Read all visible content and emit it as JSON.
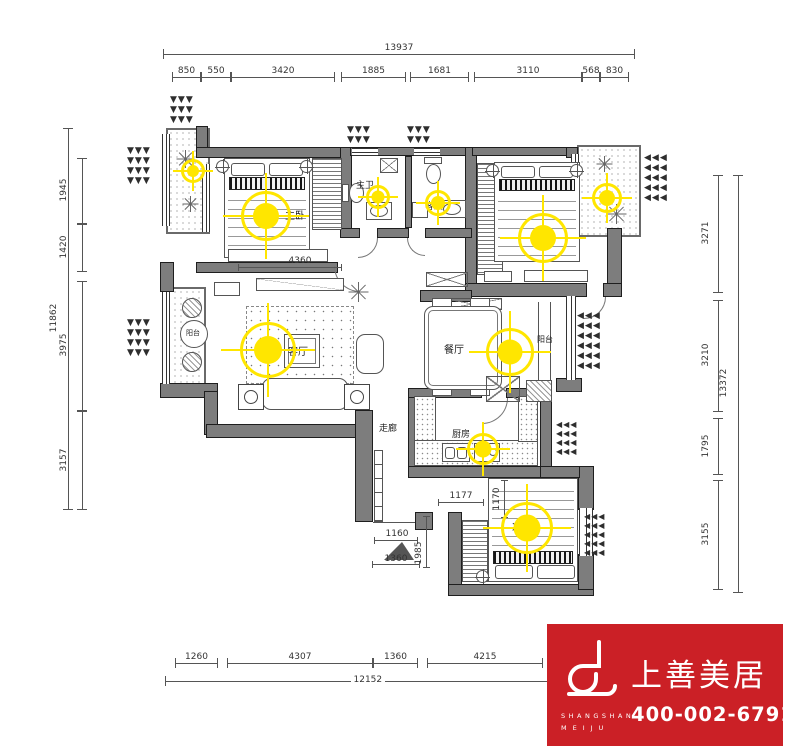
{
  "dims": {
    "top": {
      "total": "13937",
      "segments": [
        "850",
        "550",
        "3420",
        "1885",
        "1681",
        "3110",
        "568",
        "830"
      ]
    },
    "bottom": {
      "total": "12152",
      "segments": [
        "1260",
        "4307",
        "1360",
        "4215"
      ]
    },
    "left": {
      "total": "11862",
      "segments": [
        "1945",
        "1420",
        "3975",
        "3157"
      ]
    },
    "right": {
      "total": "13372",
      "segments": [
        "3271",
        "3210",
        "1795",
        "3155"
      ]
    },
    "interior": {
      "master_width": "4360",
      "kitchen_width": "1177",
      "hall_depth": "1170",
      "entry_a": "1160",
      "entry_b": "1360",
      "entry_depth": "1985"
    }
  },
  "rooms": {
    "master_bedroom": "主卧",
    "master_bath": "主卫",
    "guest_bath": "客卫",
    "bedroom_2": "客卧",
    "living_room": "客厅",
    "dining_room": "餐厅",
    "kitchen": "厨房",
    "corridor": "走廊",
    "balcony_left": "阳台",
    "balcony_right": "阳台",
    "bedroom_3": "次卧"
  },
  "icons": {
    "arrow_down": "▼",
    "arrow_left": "◀",
    "light_symbol": "ceiling-light-target"
  },
  "logo": {
    "brand": "上善美居",
    "brand_en_1": "SHANGSHAN",
    "brand_en_2": "MEIJU",
    "phone": "400-002-6791"
  },
  "colors": {
    "wall": "#7d7d7d",
    "highlight": "#ffe600",
    "logo_red": "#cb2026"
  }
}
